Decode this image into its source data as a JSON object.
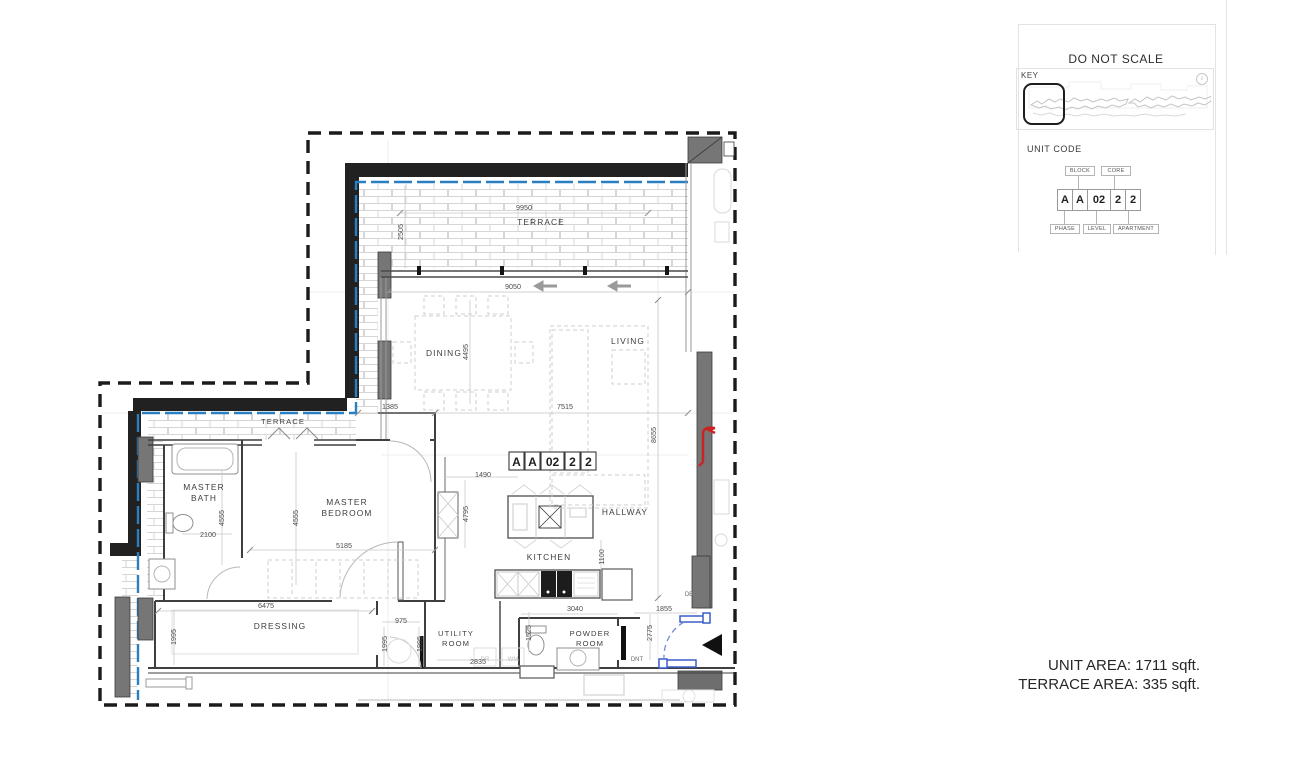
{
  "panel": {
    "title": "DO NOT SCALE",
    "key_label": "KEY",
    "info_glyph": "i",
    "unit_code_label": "UNIT CODE",
    "code_cells": [
      "A",
      "A",
      "02",
      "2",
      "2"
    ],
    "labels_top": [
      "BLOCK",
      "CORE"
    ],
    "labels_bottom": [
      "PHASE",
      "LEVEL",
      "APARTMENT"
    ]
  },
  "areas": {
    "unit_area": "UNIT AREA: 1711 sqft.",
    "terrace_area": "TERRACE AREA: 335 sqft."
  },
  "plan": {
    "unit_tag": [
      "A",
      "A",
      "02",
      "2",
      "2"
    ],
    "rooms": {
      "terrace_top": "TERRACE",
      "terrace_left": "TERRACE",
      "dining": "DINING",
      "living": "LIVING",
      "master_bath_1": "MASTER",
      "master_bath_2": "BATH",
      "master_bedroom_1": "MASTER",
      "master_bedroom_2": "BEDROOM",
      "hallway": "HALLWAY",
      "kitchen": "KITCHEN",
      "dressing": "DRESSING",
      "utility_1": "UTILITY",
      "utility_2": "ROOM",
      "powder_1": "POWDER",
      "powder_2": "ROOM"
    },
    "dims": {
      "terrace_w": "9950",
      "terrace_d": "2505",
      "living_w": "9050",
      "dining_l": "4495",
      "seg_1385": "1385",
      "living_l": "7515",
      "living_d": "8655",
      "k_1490": "1490",
      "k_4795": "4795",
      "bath_d": "4555",
      "bed_d": "4555",
      "bath_w": "2100",
      "bed_w": "5185",
      "dressing_w": "6475",
      "dressing_d": "1995",
      "door_w": "975",
      "d_1995b": "1995",
      "d_1995c": "1995",
      "k_1100": "1100",
      "utility_w": "2835",
      "p_1525": "1525",
      "entry_3040": "3040",
      "entry_2775": "2775",
      "entry_1855": "1855"
    },
    "tags": {
      "dr": "DR",
      "wm": "WM",
      "dnt": "DNT",
      "db": "DB"
    }
  },
  "colors": {
    "wall": "#212121",
    "terrace_line": "#2a7fc1",
    "entry_door": "#3a5fc8",
    "alert": "#cc2222"
  }
}
